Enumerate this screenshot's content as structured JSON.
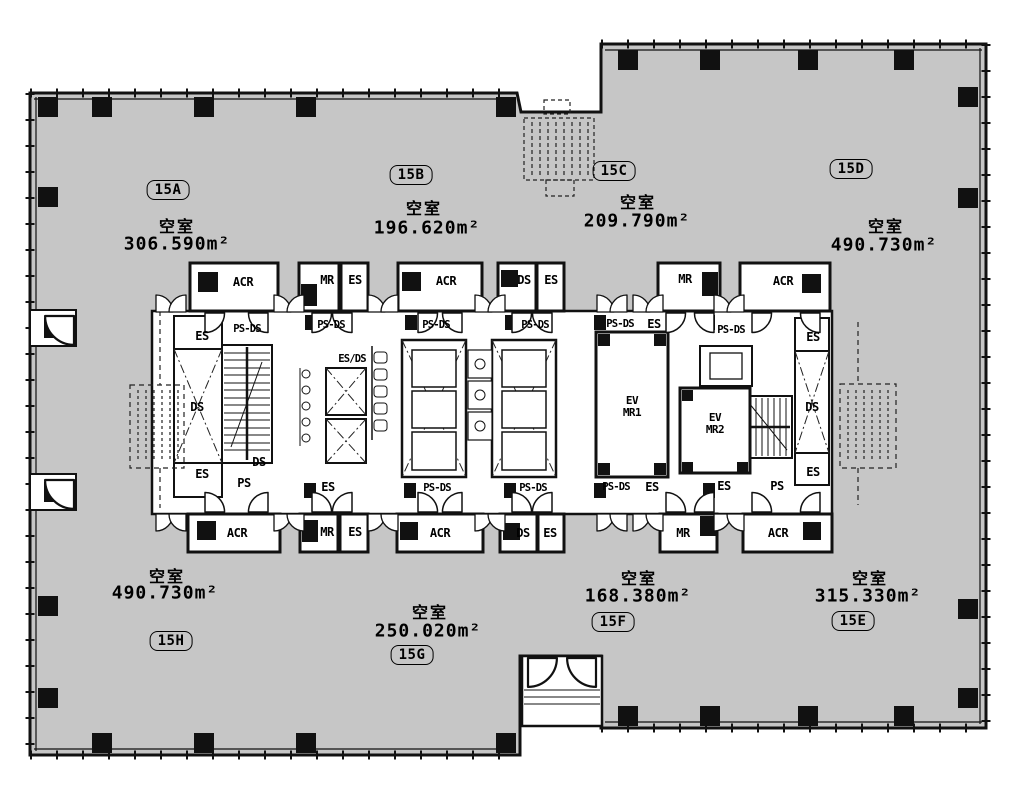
{
  "plan": {
    "colors": {
      "floor_fill": "#c6c6c6",
      "line": "#111111",
      "core_fill": "#ffffff"
    },
    "units": [
      {
        "id": "15A",
        "status": "空室",
        "area": "306.590m²"
      },
      {
        "id": "15B",
        "status": "空室",
        "area": "196.620m²"
      },
      {
        "id": "15C",
        "status": "空室",
        "area": "209.790m²"
      },
      {
        "id": "15D",
        "status": "空室",
        "area": "490.730m²"
      },
      {
        "id": "15E",
        "status": "空室",
        "area": "315.330m²"
      },
      {
        "id": "15F",
        "status": "空室",
        "area": "168.380m²"
      },
      {
        "id": "15G",
        "status": "空室",
        "area": "250.020m²"
      },
      {
        "id": "15H",
        "status": "空室",
        "area": "490.730m²"
      }
    ],
    "rooms": {
      "acr": "ACR",
      "mr": "MR",
      "es": "ES",
      "ds": "DS",
      "ps": "PS",
      "ps_ds": "PS-DS",
      "es_ds": "ES/DS",
      "ev": "EV",
      "mr1": "MR1",
      "mr2": "MR2"
    }
  }
}
